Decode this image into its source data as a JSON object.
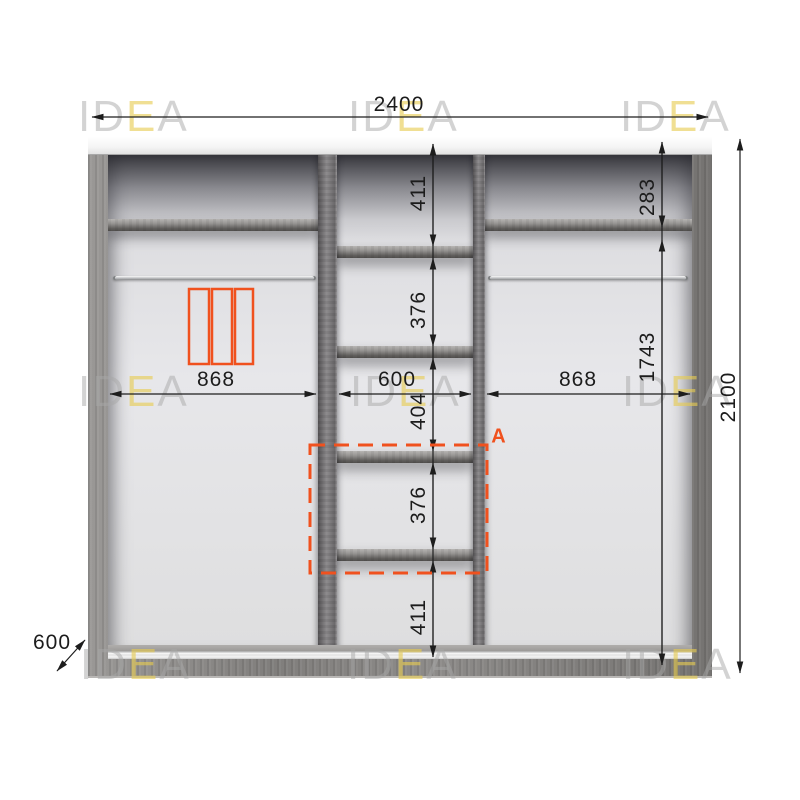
{
  "watermark": {
    "pre": "ID",
    "accent": "E",
    "post": "A"
  },
  "diagram": {
    "dimensions": {
      "total_width": "2400",
      "total_height": "2100",
      "depth": "600",
      "right_top_gap": "283",
      "right_lower_height": "1743",
      "left_section_width": "868",
      "center_section_width": "600",
      "right_section_width": "868",
      "center_segments": [
        "411",
        "376",
        "404",
        "376",
        "411"
      ]
    },
    "section_marker": "A",
    "accent_color": "#F0511E"
  }
}
